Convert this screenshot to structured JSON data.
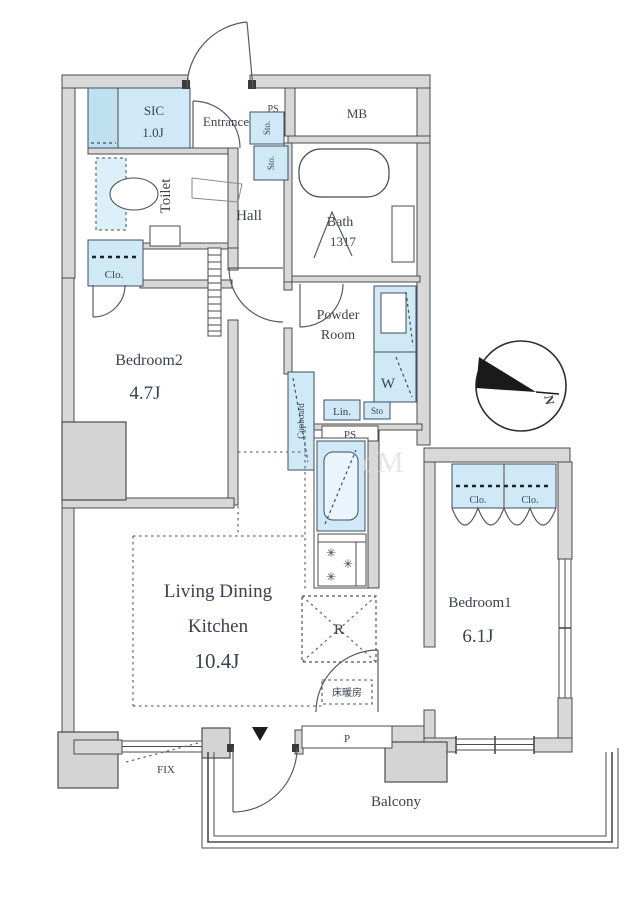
{
  "rooms": {
    "sic": {
      "name": "SIC",
      "area": "1.0J"
    },
    "entrance": {
      "name": "Entrance"
    },
    "toilet": {
      "name": "Toilet"
    },
    "hall": {
      "name": "Hall"
    },
    "meter_box": {
      "name": "MB"
    },
    "bath": {
      "name": "Bath",
      "size": "1317"
    },
    "powder_room": {
      "line1": "Powder",
      "line2": "Room"
    },
    "bedroom2": {
      "name": "Bedroom2",
      "area": "4.7J"
    },
    "ldk": {
      "line1": "Living Dining",
      "line2": "Kitchen",
      "area": "10.4J"
    },
    "bedroom1": {
      "name": "Bedroom1",
      "area": "6.1J"
    },
    "balcony": {
      "name": "Balcony"
    }
  },
  "fixtures": {
    "pipe_space_top": "PS",
    "storage_top_1": "Sto.",
    "storage_top_2": "Sto.",
    "closet_bedroom2": "Clo.",
    "washer": "W",
    "linen": "Lin.",
    "storage_powder": "Sto",
    "pipe_space_mid": "PS",
    "cupboard": "Cupboard",
    "refrigerator": "R",
    "floor_heating": "床暖房",
    "closet_bedroom1_left": "Clo.",
    "closet_bedroom1_right": "Clo.",
    "fixed_window": "FIX",
    "pipe_duct": "P",
    "burner": "✳"
  },
  "compass": {
    "north": "N"
  },
  "watermark": "oM",
  "colors": {
    "wall_fill": "#d8d8d8",
    "wall_line": "#4b4b4b",
    "fixture_blue": "#cfe9f6",
    "text": "#3a4150"
  }
}
